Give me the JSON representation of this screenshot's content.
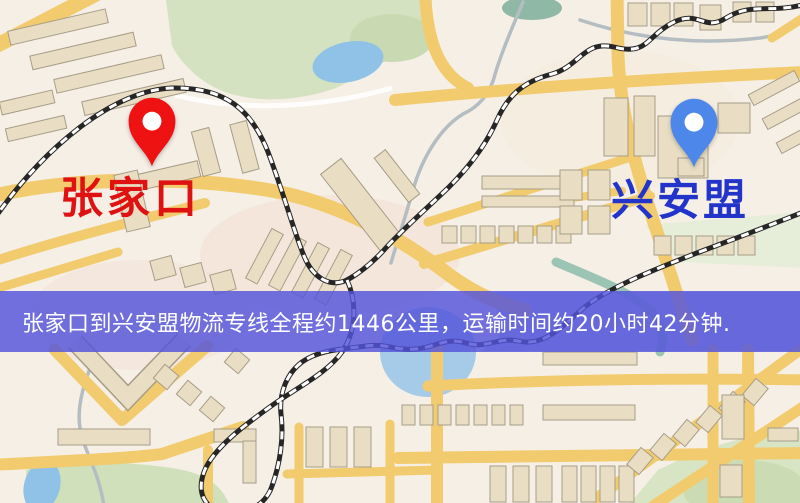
{
  "map": {
    "markers": [
      {
        "id": "origin",
        "label": "张家口",
        "pin_color": "#ee1212",
        "label_color": "#df1111",
        "pin_icon": "location-pin-icon"
      },
      {
        "id": "destination",
        "label": "兴安盟",
        "pin_color": "#4d87ea",
        "label_color": "#2334cb",
        "pin_icon": "location-pin-icon"
      }
    ],
    "banner": {
      "text": "张家口到兴安盟物流专线全程约1446公里，运输时间约20小时42分钟.",
      "distance_text": "1446公里",
      "duration_text": "20小时42分钟",
      "background": "rgba(83,83,219,0.82)",
      "text_color": "#ffffff"
    },
    "colors": {
      "map_background": "#f5efe6",
      "road_yellow": "#f2cb6e",
      "park_green": "#d5e2c1",
      "water_blue": "#8fc2e6",
      "railway_dark": "#262626"
    }
  }
}
